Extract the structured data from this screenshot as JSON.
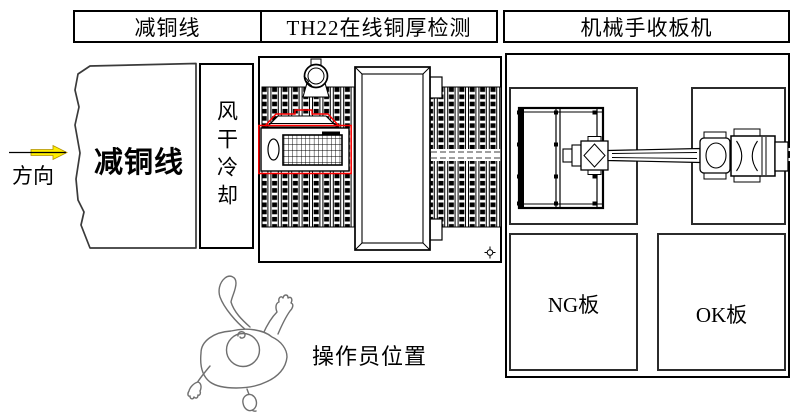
{
  "header": {
    "cells": [
      {
        "label": "减铜线"
      },
      {
        "label": "TH22在线铜厚检测"
      },
      {
        "label": "机械手收板机"
      }
    ]
  },
  "flow_direction": {
    "label": "方向"
  },
  "copper_line": {
    "label": "减铜线"
  },
  "air_dry_cooling": {
    "label": "风干冷却"
  },
  "collector": {
    "ng_board_label": "NG板",
    "ok_board_label": "OK板"
  },
  "operator": {
    "label": "操作员位置"
  },
  "colors": {
    "detector_highlight": "#ff0000",
    "direction_arrow": "#ffee00",
    "line": "#000000",
    "operator_sketch": "#6f6f6f"
  },
  "icons": {
    "direction_arrow": "yellow-right-arrow",
    "hoist_ring": "ring-on-stand",
    "position_marker": "crosshair-symbol"
  }
}
